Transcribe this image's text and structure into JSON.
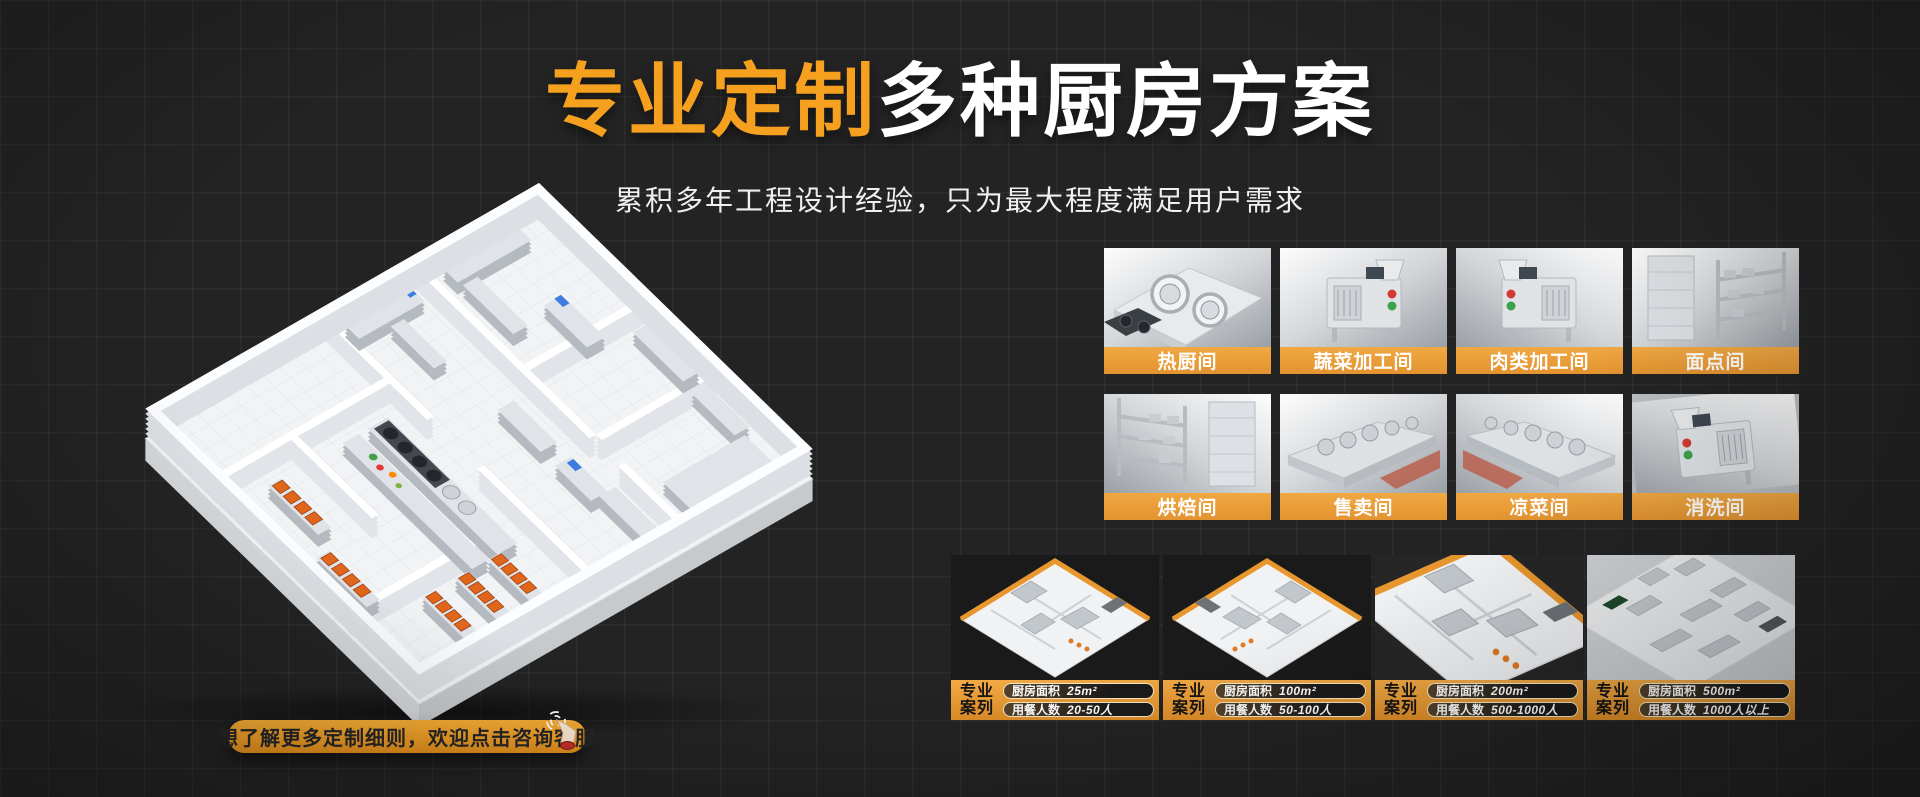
{
  "page": {
    "width": 1920,
    "height": 797,
    "background": "#232323",
    "grid_line_color": "#2E2E2E"
  },
  "header": {
    "title_highlight": "专业定制",
    "title_rest": "多种厨房方案",
    "subtitle": "累积多年工程设计经验，只为最大程度满足用户需求"
  },
  "colors": {
    "accent_orange": "#F5A01F",
    "tile_label_bar": "#EBA23C",
    "case_bar": "#E9992F",
    "cta_background": "#EE9D27",
    "cta_text": "#262626",
    "title_white": "#FFFFFF"
  },
  "illustrations": {
    "floorplan": "isometric-kitchen-floorplan",
    "cta_icon": "hand-click-icon"
  },
  "cta": {
    "label": "想了解更多定制细则，欢迎点击咨询客服"
  },
  "room_tiles": [
    {
      "label": "热厨间"
    },
    {
      "label": "蔬菜加工间"
    },
    {
      "label": "肉类加工间"
    },
    {
      "label": "面点间"
    },
    {
      "label": "烘焙间"
    },
    {
      "label": "售卖间"
    },
    {
      "label": "凉菜间"
    },
    {
      "label": "消洗间"
    }
  ],
  "case_cards": [
    {
      "badge_line1": "专业",
      "badge_line2": "案列",
      "area_label": "厨房面积",
      "area_value": "25m²",
      "diners_label": "用餐人数",
      "diners_value": "20-50人"
    },
    {
      "badge_line1": "专业",
      "badge_line2": "案列",
      "area_label": "厨房面积",
      "area_value": "100m²",
      "diners_label": "用餐人数",
      "diners_value": "50-100人"
    },
    {
      "badge_line1": "专业",
      "badge_line2": "案列",
      "area_label": "厨房面积",
      "area_value": "200m²",
      "diners_label": "用餐人数",
      "diners_value": "500-1000人"
    },
    {
      "badge_line1": "专业",
      "badge_line2": "案列",
      "area_label": "厨房面积",
      "area_value": "500m²",
      "diners_label": "用餐人数",
      "diners_value": "1000人以上"
    }
  ]
}
